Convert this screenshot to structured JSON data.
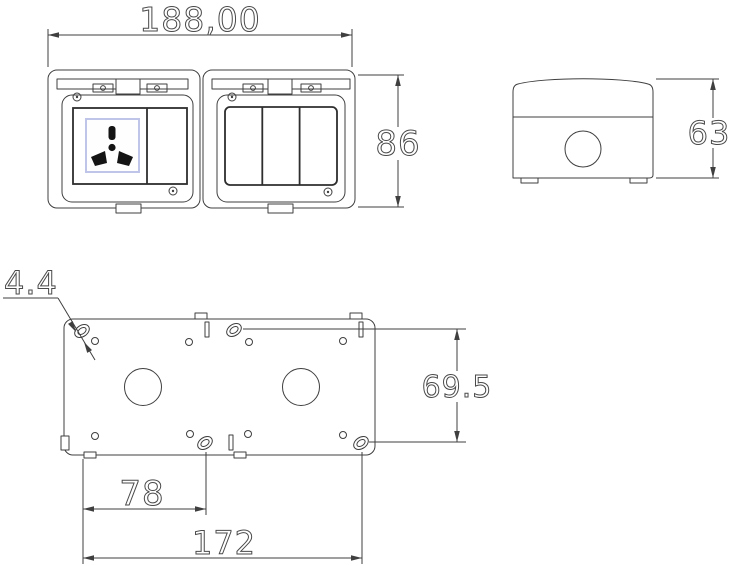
{
  "dimensions": {
    "overall_width": "188,00",
    "overall_height": "86",
    "depth": "63",
    "slot_diameter": "4.4",
    "mount_vertical_spacing": "69.5",
    "mount_offset": "78",
    "mount_horizontal_spacing": "172"
  },
  "colors": {
    "line": "#3f3f3f",
    "background": "#ffffff",
    "socket_accent": "#bfc5e8",
    "pin": "#141414"
  }
}
